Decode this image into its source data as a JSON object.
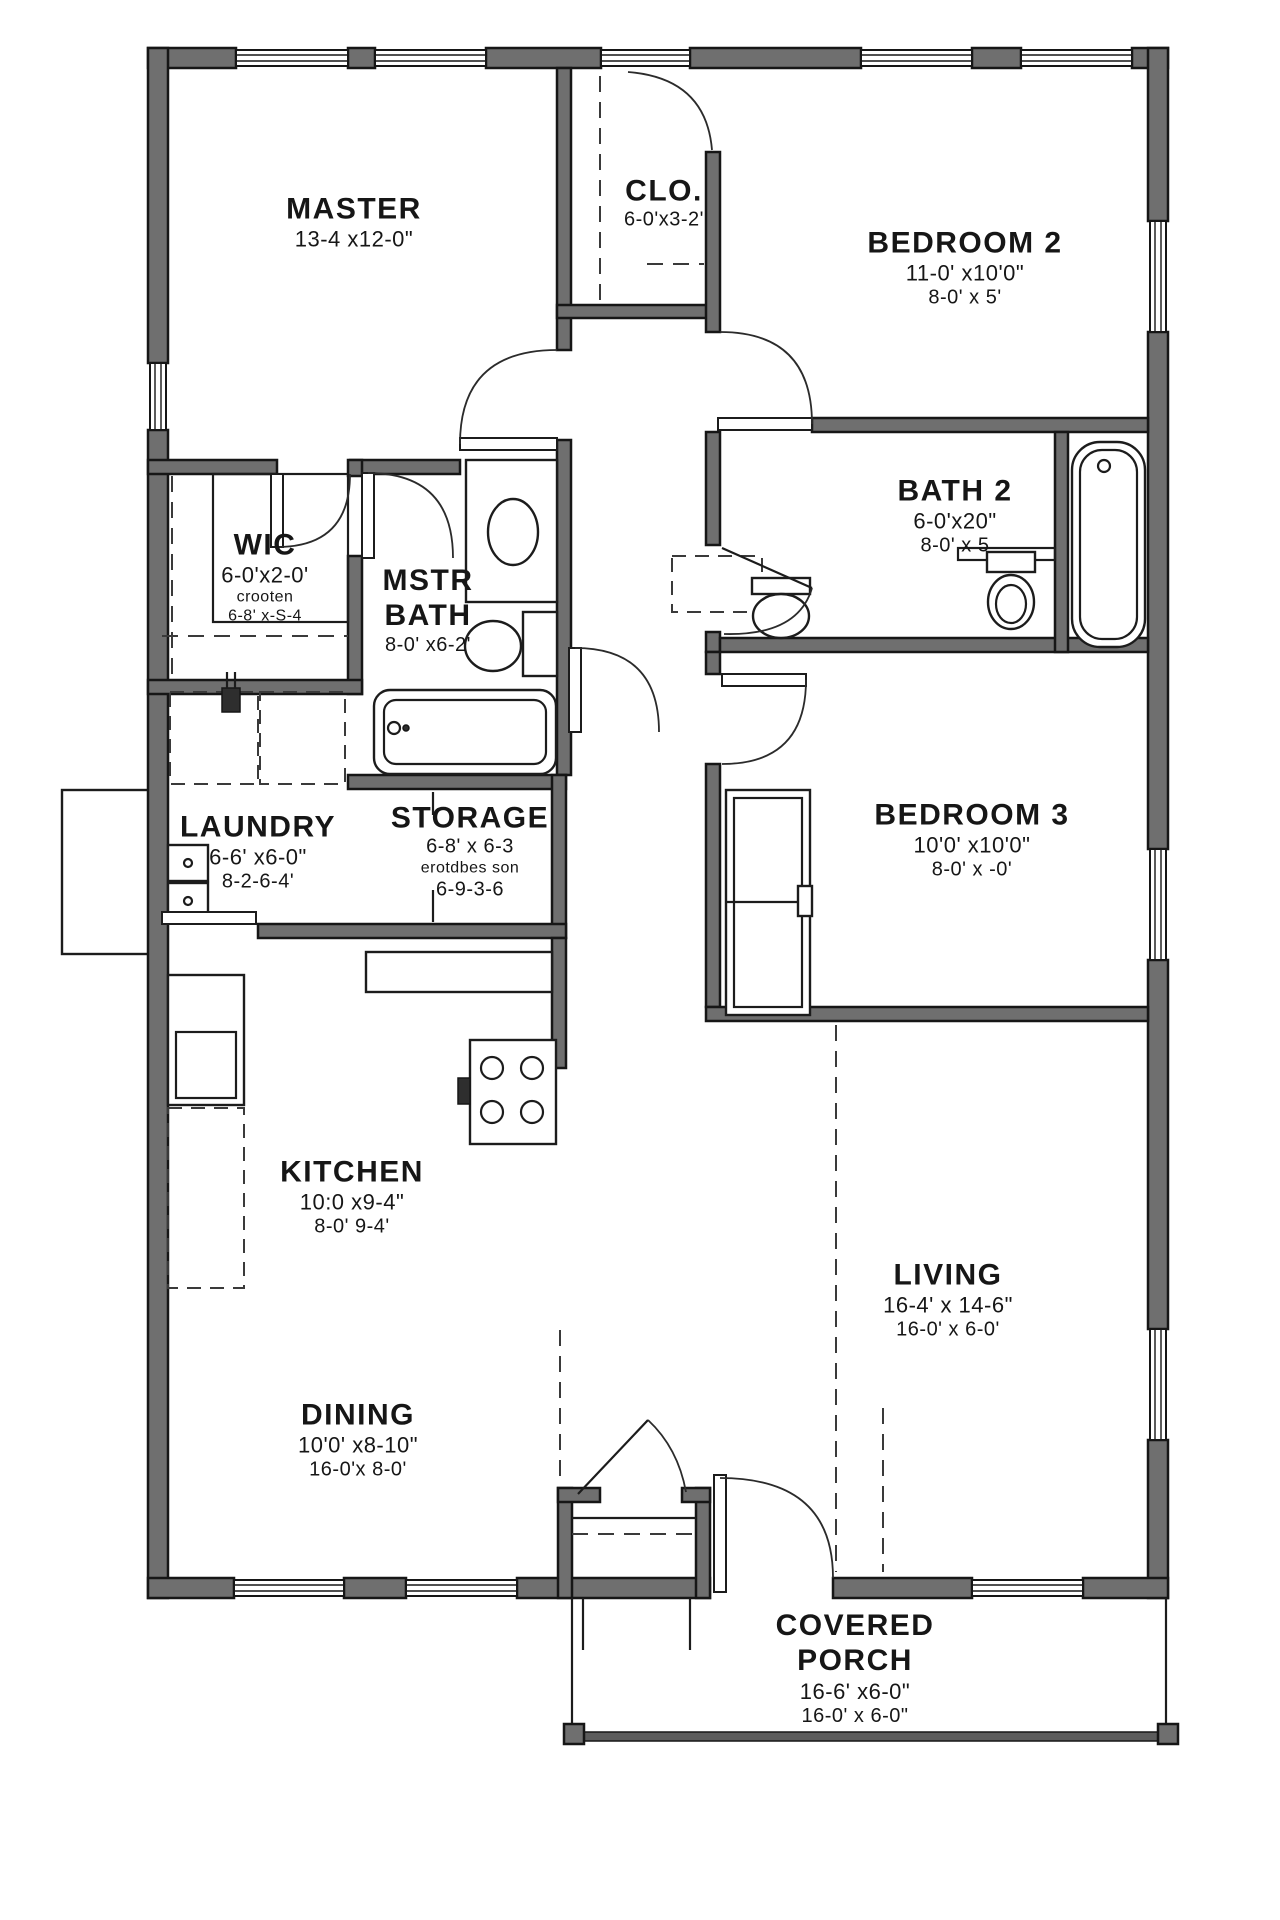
{
  "title": "house-floor-plan",
  "colors": {
    "wall": "#6f6f6f",
    "line": "#161616",
    "background": "#ffffff"
  },
  "rooms": {
    "master": {
      "name": "MASTER",
      "dims": [
        "13-4 x12-0\""
      ]
    },
    "closet": {
      "name": "CLO.",
      "dims": [
        "6-0'x3-2'"
      ]
    },
    "bedroom2": {
      "name": "BEDROOM 2",
      "dims": [
        "11-0' x10'0\"",
        "8-0' x 5'"
      ]
    },
    "bath2": {
      "name": "BATH 2",
      "dims": [
        "6-0'x20\"",
        "8-0' x 5"
      ]
    },
    "wic": {
      "name": "WIC",
      "dims": [
        "6-0'x2-0'",
        "crooten",
        "6-8' x-S-4"
      ]
    },
    "mstr_bath": {
      "name": "MSTR",
      "name2": "BATH",
      "dims": [
        "8-0' x6-2'"
      ]
    },
    "laundry": {
      "name": "LAUNDRY",
      "dims": [
        "6-6' x6-0\"",
        "8-2-6-4'"
      ]
    },
    "storage": {
      "name": "STORAGE",
      "dims": [
        "6-8' x 6-3",
        "erotdbes son",
        "6-9-3-6"
      ]
    },
    "bedroom3": {
      "name": "BEDROOM 3",
      "dims": [
        "10'0' x10'0\"",
        "8-0' x -0'"
      ]
    },
    "kitchen": {
      "name": "KITCHEN",
      "dims": [
        "10:0 x9-4\"",
        "8-0' 9-4'"
      ]
    },
    "living": {
      "name": "LIVING",
      "dims": [
        "16-4' x 14-6\"",
        "16-0' x 6-0'"
      ]
    },
    "dining": {
      "name": "DINING",
      "dims": [
        "10'0' x8-10\"",
        "16-0'x 8-0'"
      ]
    },
    "porch": {
      "name": "COVERED",
      "name2": "PORCH",
      "dims": [
        "16-6' x6-0\"",
        "16-0' x 6-0\""
      ]
    }
  },
  "fixtures": [
    "bathtub",
    "toilet",
    "sink",
    "stove",
    "washer-dryer",
    "wardrobe",
    "window",
    "door"
  ]
}
